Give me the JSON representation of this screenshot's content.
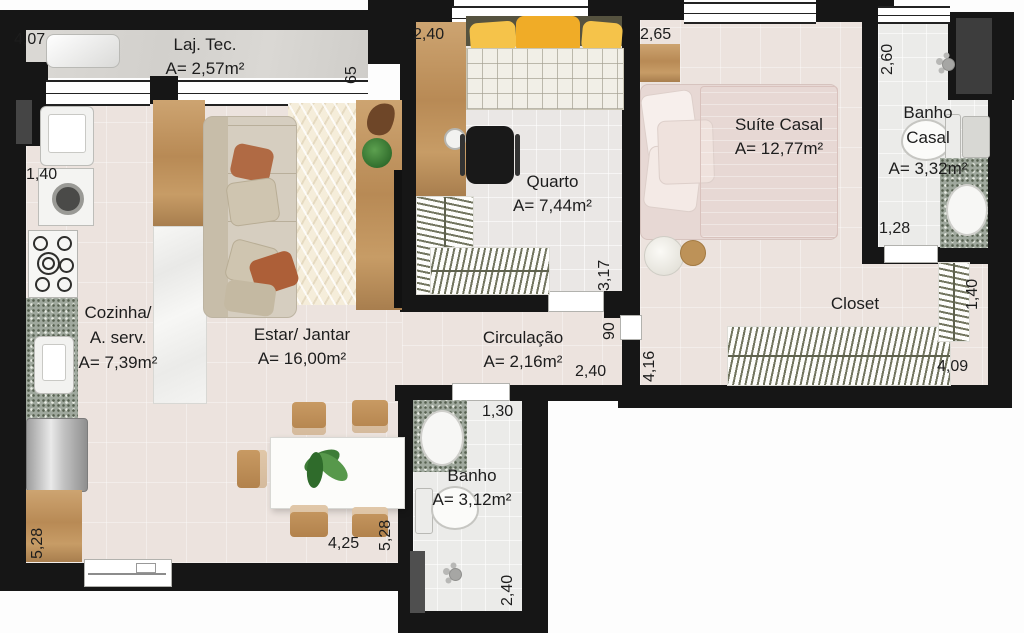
{
  "plan_title": "Apartment floor plan",
  "rooms": {
    "laj_tec": {
      "name": "Laj. Tec.",
      "area": "A= 2,57m²"
    },
    "quarto": {
      "name": "Quarto",
      "area": "A= 7,44m²"
    },
    "suite": {
      "name": "Suíte Casal",
      "area": "A= 12,77m²"
    },
    "banho_casal": {
      "name_line1": "Banho",
      "name_line2": "Casal",
      "area": "A= 3,32m²"
    },
    "cozinha": {
      "name_line1": "Cozinha/",
      "name_line2": "A. serv.",
      "area": "A= 7,39m²"
    },
    "estar": {
      "name": "Estar/ Jantar",
      "area": "A= 16,00m²"
    },
    "circulacao": {
      "name": "Circulação",
      "area": "A= 2,16m²"
    },
    "closet": {
      "name": "Closet"
    },
    "banho": {
      "name": "Banho",
      "area": "A= 3,12m²"
    }
  },
  "dimensions": {
    "laj_width": "4,07",
    "laj_depth": "65",
    "quarto_width": "2,40",
    "suite_width": "2,65",
    "banho_casal_depth": "2,60",
    "kitchen_width": "1,40",
    "banho_casal_width": "1,28",
    "quarto_depth": "3,17",
    "circ_door": "90",
    "suite_depth": "4,16",
    "circ_width": "2,40",
    "banho_width": "1,30",
    "closet_rack": "1,40",
    "closet_width": "4,09",
    "living_depth_left": "5,28",
    "living_width": "4,25",
    "living_depth_right": "5,28",
    "banho_depth": "2,40"
  },
  "colors": {
    "wall": "#161616",
    "floor_main": "#ece3de",
    "floor_wet": "#ebebe9",
    "slab_concrete": "#d6d4d0",
    "wood": "#c49a6a",
    "granite": "#9fa89d",
    "pillow_yellow": "#f2b52f",
    "bed_pink": "#ecd9d5",
    "plant_green": "#3e7c37",
    "text": "#1d1d1d"
  }
}
